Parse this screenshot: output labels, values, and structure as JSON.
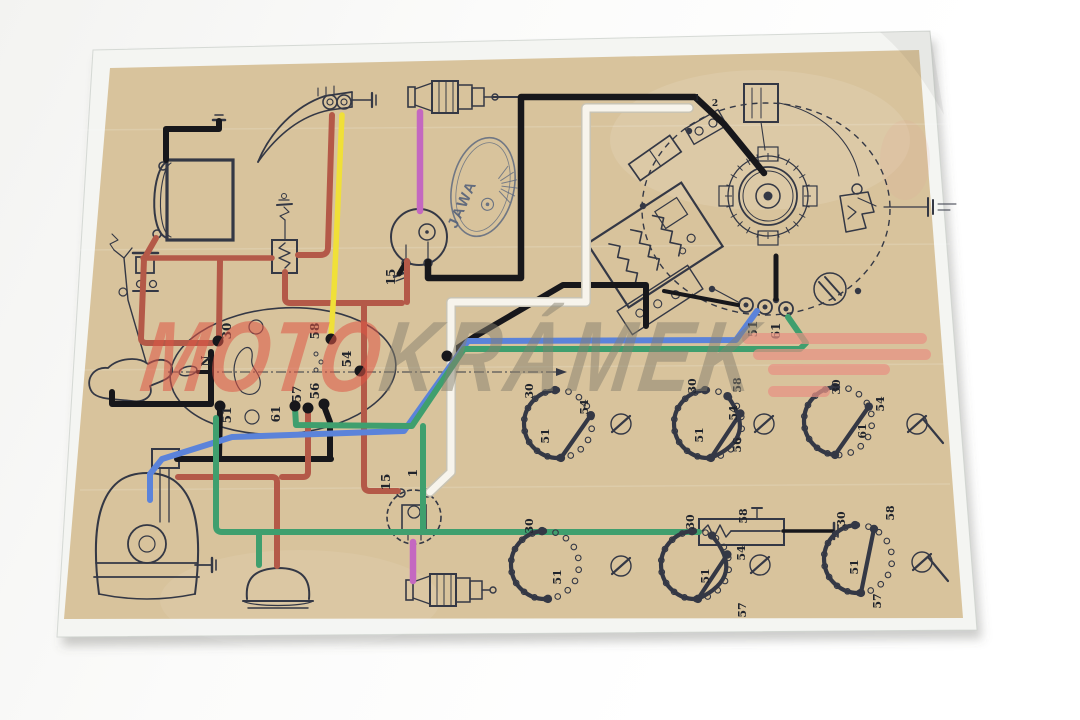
{
  "scene": {
    "width": 1080,
    "height": 720
  },
  "watermark": {
    "moto": "MOTO",
    "kramek": "KRÁMEK",
    "moto_color": "rgba(223,86,69,0.55)",
    "kramek_color": "rgba(134,127,110,0.50)",
    "bars_color": "#e89184",
    "bars": [
      [
        742,
        333,
        185,
        11
      ],
      [
        753,
        349,
        178,
        11
      ],
      [
        768,
        364,
        122,
        11
      ],
      [
        768,
        386,
        62,
        11
      ]
    ]
  },
  "logo": {
    "text": "JAWA"
  },
  "colors": {
    "backdrop": "#fafaf9",
    "paper": "#f4f5f2",
    "print_tan": "#d8c39c",
    "line": "#343845",
    "label": "#20242c",
    "wire_black": "#17171b",
    "wire_red": "#b45948",
    "wire_yellow": "#f0e038",
    "wire_magenta": "#c468c0",
    "wire_blue": "#5b83da",
    "wire_green": "#3f9f6e",
    "wire_white": "#f7f4ec",
    "wire_white_edge": "#c9c4b4"
  },
  "paper_corners": "93,50 930,31 977,630 57,637",
  "tan_corners": "110,68 919,50 963,618 64,619",
  "terminal_labels": [
    {
      "t": "30",
      "x": 231,
      "y": 331
    },
    {
      "t": "58",
      "x": 319,
      "y": 331
    },
    {
      "t": "54",
      "x": 351,
      "y": 359
    },
    {
      "t": "N",
      "x": 210,
      "y": 361
    },
    {
      "t": "51",
      "x": 231,
      "y": 415
    },
    {
      "t": "61",
      "x": 280,
      "y": 414
    },
    {
      "t": "57",
      "x": 301,
      "y": 394
    },
    {
      "t": "56",
      "x": 319,
      "y": 391
    },
    {
      "t": "15",
      "x": 395,
      "y": 277
    },
    {
      "t": "15",
      "x": 390,
      "y": 482
    },
    {
      "t": "1",
      "x": 417,
      "y": 473
    },
    {
      "t": "51",
      "x": 757,
      "y": 329
    },
    {
      "t": "61",
      "x": 780,
      "y": 331
    },
    {
      "t": "1",
      "x": 697,
      "y": 101,
      "rot": 0,
      "s": 9
    },
    {
      "t": "2",
      "x": 715,
      "y": 106,
      "rot": 0,
      "s": 9
    }
  ],
  "terminal_dots": [
    [
      218,
      341
    ],
    [
      331,
      339
    ],
    [
      360,
      371
    ],
    [
      220,
      406
    ],
    [
      295,
      406
    ],
    [
      308,
      408
    ],
    [
      324,
      404
    ],
    [
      447,
      356
    ]
  ],
  "wires": [
    {
      "name": "battery-ground-wire",
      "c": "wire_black",
      "w": 6,
      "d": "M166,160 L166,129 L219,129 L219,121"
    },
    {
      "name": "coil1-to-magneto-wire",
      "c": "wire_black",
      "w": 6.5,
      "d": "M428,262 L428,278 L521,278 L521,97 L695,97 L724,124 L764,173"
    },
    {
      "name": "coil1-ground-stub",
      "c": "wire_black",
      "w": 5,
      "d": "M406,262 L399,274"
    },
    {
      "name": "junction-crossover-wire",
      "c": "wire_black",
      "w": 6,
      "d": "M646,326 L646,285 L563,285 L474,337 L447,355"
    },
    {
      "name": "junction-to-block-wire",
      "c": "wire_black",
      "w": 4,
      "d": "M664,291 L738,305"
    },
    {
      "name": "magneto-to-block-wire",
      "c": "wire_black",
      "w": 5,
      "d": "M776,256 L776,299"
    },
    {
      "name": "switch51-drop-wire",
      "c": "wire_black",
      "w": 6,
      "d": "M220,410 L219,458"
    },
    {
      "name": "switch56-drop-wire",
      "c": "wire_black",
      "w": 6,
      "d": "M324,406 L330,422 L330,458"
    },
    {
      "name": "headlamp-feed-wire",
      "c": "wire_black",
      "w": 6,
      "d": "M177,459 L331,459"
    },
    {
      "name": "horn-button-wire",
      "c": "wire_black",
      "w": 6,
      "d": "M112,392 L112,404 L211,404 L211,352"
    },
    {
      "name": "n-terminal-stub",
      "c": "wire_black",
      "w": 4,
      "d": "M198,372 L211,372"
    },
    {
      "name": "brake-switch-ground-wire",
      "c": "wire_black",
      "w": 3.5,
      "d": "M783,531 L833,531"
    },
    {
      "name": "white-wire-magneto-to-coil2",
      "c": "wire_white",
      "w": 7,
      "d": "M689,108 L586,108 L586,302 L451,302 L451,472 L430,492"
    },
    {
      "name": "battery-to-fuse-wire",
      "c": "wire_red",
      "w": 6,
      "d": "M156,238 L144,259 L141,338 Q141,343 147,343 L212,343"
    },
    {
      "name": "fuse-to-box-wire",
      "c": "wire_red",
      "w": 5.5,
      "d": "M143,258 L272,258"
    },
    {
      "name": "terminal30-drop-wire",
      "c": "wire_red",
      "w": 6,
      "d": "M220,261 L219,337"
    },
    {
      "name": "horn-to-box-wire",
      "c": "wire_red",
      "w": 6,
      "d": "M332,115 L328,247 Q328,255 320,255 L298,255"
    },
    {
      "name": "box-to-ignition-wire",
      "c": "wire_red",
      "w": 6,
      "d": "M285,272 L285,298 Q285,303 290,303 L402,303"
    },
    {
      "name": "coil1-feed-drop",
      "c": "wire_red",
      "w": 6,
      "d": "M407,261 L407,302"
    },
    {
      "name": "switch54-to-coil2-wire",
      "c": "wire_red",
      "w": 6,
      "d": "M364,303 L364,485 Q364,491 370,491 L398,491"
    },
    {
      "name": "switch57-drop-wire",
      "c": "wire_red",
      "w": 6,
      "d": "M308,410 L308,472 Q308,477 303,477 L282,477"
    },
    {
      "name": "taillight-feed-wire",
      "c": "wire_red",
      "w": 6,
      "d": "M178,477 L272,477 Q277,477 277,482 L277,566"
    },
    {
      "name": "horn-to-switch58-wire",
      "c": "wire_yellow",
      "w": 5.5,
      "d": "M342,115 L334,290 L331,337"
    },
    {
      "name": "plug1-ht-lead",
      "c": "wire_magenta",
      "w": 6.5,
      "d": "M420,112 L420,211"
    },
    {
      "name": "plug2-ht-lead",
      "c": "wire_magenta",
      "w": 6.5,
      "d": "M413,542 L413,581"
    },
    {
      "name": "magneto51-to-headlamp-wire",
      "c": "wire_blue",
      "w": 6,
      "d": "M757,311 L736,340 L468,341 L404,431 L232,437 L162,459 L150,474 L150,500"
    },
    {
      "name": "switch61-to-magneto61-wire",
      "c": "wire_green",
      "w": 6,
      "d": "M295,408 L296,425 L412,426 L464,349 L800,349 L806,343 L788,317"
    },
    {
      "name": "brake-branch-wire",
      "c": "wire_green",
      "w": 6,
      "d": "M423,426 L423,531"
    },
    {
      "name": "brake-run-wire",
      "c": "wire_green",
      "w": 6,
      "d": "M216,418 L216,526 Q216,532 222,532 L699,532"
    },
    {
      "name": "taillamp-stub-wire",
      "c": "wire_green",
      "w": 6,
      "d": "M259,532 L259,565"
    }
  ],
  "switch_diagrams": [
    {
      "name": "switch-position-diagram-1",
      "cx": 558,
      "cy": 424,
      "r": 34,
      "arc": [
        -95,
        85
      ],
      "bars": [
        [
          85,
          -15
        ]
      ],
      "curve": null,
      "key": [
        621,
        424,
        0
      ],
      "labels": [
        {
          "t": "30",
          "x": 533,
          "y": 391
        },
        {
          "t": "54",
          "x": 588,
          "y": 407
        },
        {
          "t": "51",
          "x": 549,
          "y": 436
        }
      ]
    },
    {
      "name": "switch-position-diagram-2",
      "cx": 708,
      "cy": 424,
      "r": 34,
      "arc": [
        -95,
        85
      ],
      "bars": [
        [
          85,
          -18
        ]
      ],
      "curve": [
        85,
        -55
      ],
      "key": [
        764,
        424,
        0
      ],
      "labels": [
        {
          "t": "30",
          "x": 696,
          "y": 386
        },
        {
          "t": "58",
          "x": 741,
          "y": 385
        },
        {
          "t": "54",
          "x": 737,
          "y": 413
        },
        {
          "t": "51",
          "x": 703,
          "y": 435
        },
        {
          "t": "56",
          "x": 741,
          "y": 445
        }
      ]
    },
    {
      "name": "switch-position-diagram-3",
      "cx": 838,
      "cy": 421,
      "r": 34,
      "arc": [
        -95,
        95
      ],
      "bars": [
        [
          95,
          -25
        ]
      ],
      "curve": null,
      "key": [
        917,
        424,
        1
      ],
      "labels": [
        {
          "t": "30",
          "x": 840,
          "y": 387
        },
        {
          "t": "54",
          "x": 884,
          "y": 404
        },
        {
          "t": "61",
          "x": 866,
          "y": 431
        }
      ]
    },
    {
      "name": "switch-position-diagram-4",
      "cx": 545,
      "cy": 565,
      "r": 34,
      "arc": [
        -95,
        85
      ],
      "bars": [],
      "curve": null,
      "key": [
        621,
        566,
        0
      ],
      "labels": [
        {
          "t": "30",
          "x": 533,
          "y": 526
        },
        {
          "t": "51",
          "x": 561,
          "y": 577
        }
      ]
    },
    {
      "name": "switch-position-diagram-5",
      "cx": 695,
      "cy": 565,
      "r": 34,
      "arc": [
        -95,
        85
      ],
      "bars": [
        [
          85,
          -18
        ]
      ],
      "curve": [
        85,
        -60
      ],
      "key": [
        760,
        565,
        0
      ],
      "labels": [
        {
          "t": "30",
          "x": 694,
          "y": 522
        },
        {
          "t": "58",
          "x": 747,
          "y": 516
        },
        {
          "t": "54",
          "x": 745,
          "y": 553
        },
        {
          "t": "51",
          "x": 709,
          "y": 576
        },
        {
          "t": "57",
          "x": 746,
          "y": 610
        }
      ]
    },
    {
      "name": "switch-position-diagram-6",
      "cx": 858,
      "cy": 559,
      "r": 34,
      "arc": [
        -95,
        85
      ],
      "bars": [
        [
          85,
          -62
        ]
      ],
      "curve": null,
      "key": [
        922,
        562,
        1
      ],
      "labels": [
        {
          "t": "30",
          "x": 845,
          "y": 519
        },
        {
          "t": "58",
          "x": 894,
          "y": 513
        },
        {
          "t": "51",
          "x": 858,
          "y": 567
        },
        {
          "t": "57",
          "x": 881,
          "y": 601
        }
      ]
    }
  ]
}
